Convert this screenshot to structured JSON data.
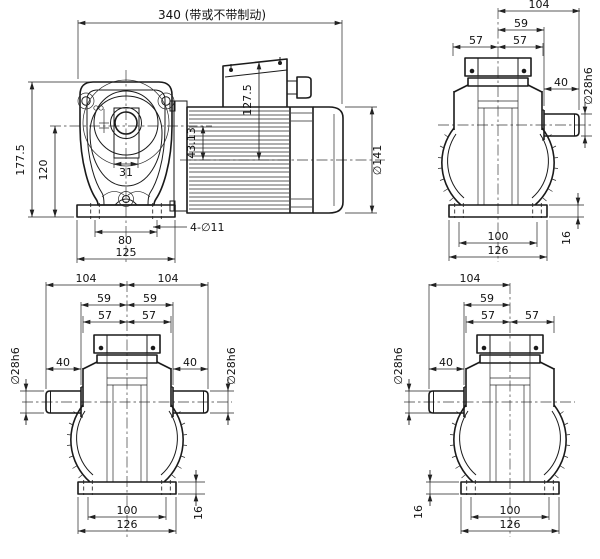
{
  "colors": {
    "line": "#1a1a1a",
    "dim": "#222222",
    "background": "#ffffff"
  },
  "front": {
    "len340": "340 (带或不带制动)",
    "h177": "177.5",
    "h120": "120",
    "w31": "31",
    "w80": "80",
    "w125": "125",
    "holes": "4-∅11",
    "dia141": "∅141",
    "h127": "127.5",
    "off43": "43.13"
  },
  "tr": {
    "l104": "104",
    "l59": "59",
    "l57a": "57",
    "l57b": "57",
    "l40": "40",
    "dia28": "∅28h6",
    "b100": "100",
    "b126": "126",
    "h16": "16"
  },
  "bl": {
    "l104a": "104",
    "l104b": "104",
    "l59a": "59",
    "l59b": "59",
    "l57a": "57",
    "l57b": "57",
    "l40a": "40",
    "l40b": "40",
    "dia28a": "∅28h6",
    "dia28b": "∅28h6",
    "b100": "100",
    "b126": "126",
    "h16": "16"
  },
  "br": {
    "l104": "104",
    "l59": "59",
    "l57a": "57",
    "l57b": "57",
    "l40": "40",
    "dia28": "∅28h6",
    "b100": "100",
    "b126": "126",
    "h16": "16"
  }
}
